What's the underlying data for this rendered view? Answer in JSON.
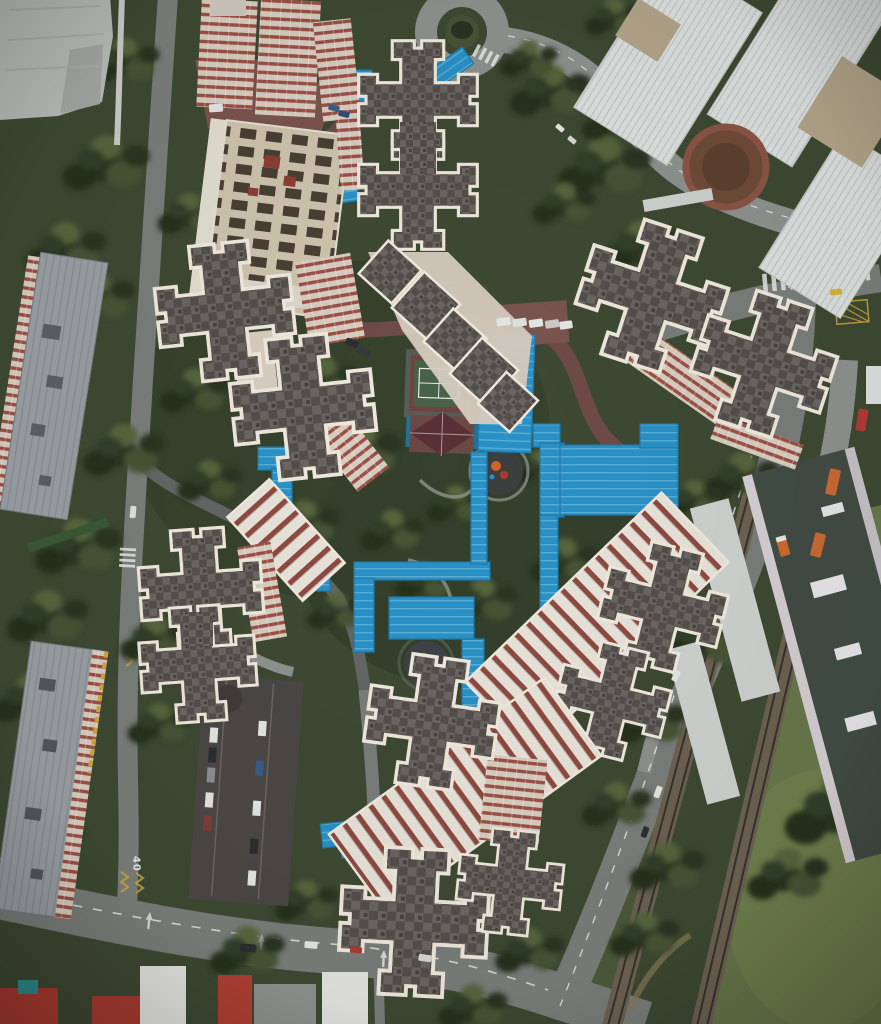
{
  "scene": {
    "type": "aerial-drone-photograph",
    "description": "Top-down aerial photograph of a high-rise housing estate: six clusters of cruciform apartment towers with grey roofs and thick white parapets surround a central garden with a games court, a pavilion, two round playgrounds and a network of bright blue covered walkways. Roads, a roundabout, a white terraced condominium complex, slab blocks, a multi-storey carpark, an elevated rail station with twin tracks and a grass field border the estate."
  },
  "labels": {
    "road_marking": "40"
  },
  "features": [
    {
      "name": "cruciform-tower-clusters",
      "count": 6
    },
    {
      "name": "blue-covered-walkway-network"
    },
    {
      "name": "central-garden"
    },
    {
      "name": "games-court"
    },
    {
      "name": "pavilion"
    },
    {
      "name": "playgrounds",
      "count": 2
    },
    {
      "name": "roundabout"
    },
    {
      "name": "white-terraced-condo-complex"
    },
    {
      "name": "circular-plaza"
    },
    {
      "name": "slab-apartment-blocks",
      "count": 3
    },
    {
      "name": "multi-storey-carpark"
    },
    {
      "name": "rail-station-roof"
    },
    {
      "name": "rail-tracks",
      "count": 2
    },
    {
      "name": "grass-field"
    },
    {
      "name": "vehicles",
      "types": [
        "vans",
        "buses",
        "cars",
        "truck",
        "taxi"
      ]
    }
  ],
  "colors": {
    "veg_base": "#3e4a33",
    "veg_dark": "#2a3423",
    "veg_mid": "#465436",
    "veg_light": "#57663e",
    "grass_field": "#68784b",
    "grass_light": "#76854f",
    "road": "#7a7f7c",
    "road_light": "#8f9390",
    "road_dark": "#636866",
    "red_road": "#6f4c47",
    "red_pavement": "#7b5550",
    "outline": "#f0eade",
    "roof_a": "#6b6661",
    "roof_b": "#544f4a",
    "cream": "#d8cec0",
    "cream_roof": "#cfc4ae",
    "slot_dark": "#4a4034",
    "stripe_red": "#9c5046",
    "ridge_white": "#e9e4da",
    "ridge_red": "#8e4a41",
    "white_bldg": "#dde1df",
    "rib_gray": "#c3c8c6",
    "tan_roof": "#b4a58a",
    "plaza_brown": "#6f4b3a",
    "plaza_ring": "#8a5546",
    "walkway_blue": "#2b92c8",
    "walkway_rib": "#59b0d6",
    "walkway_dark": "#1f7bad",
    "court_platform": "#595d59",
    "court_border": "#71443e",
    "court_green": "#49624a",
    "line_white": "#e9ebe7",
    "pavilion_roof": "#5a3136",
    "pavilion_base": "#6b4a45",
    "play_dark": "#3c403f",
    "play_orange": "#d2652a",
    "play_red": "#b03a30",
    "slab_roof": "#9aa0a4",
    "slab_rib": "#8a9094",
    "yellow": "#d0a83c",
    "carpark": "#4b4846",
    "station_roof": "#424d45",
    "station_edge": "#d6cfd3",
    "canopy": "#ced3cf",
    "ballast": "#6e6252",
    "rail": "#36342e",
    "red_roof": "#a93c31",
    "tent": "#e5e6e2",
    "teal": "#2e8e8e",
    "car_white": "#e6e8e5",
    "car_dark": "#2c2f31",
    "car_blue": "#3a5f8a",
    "bus_orange": "#c96a35",
    "bus_red": "#b23a34",
    "taxi_yellow": "#d2b53a",
    "green_canopy": "#3c5a36"
  }
}
